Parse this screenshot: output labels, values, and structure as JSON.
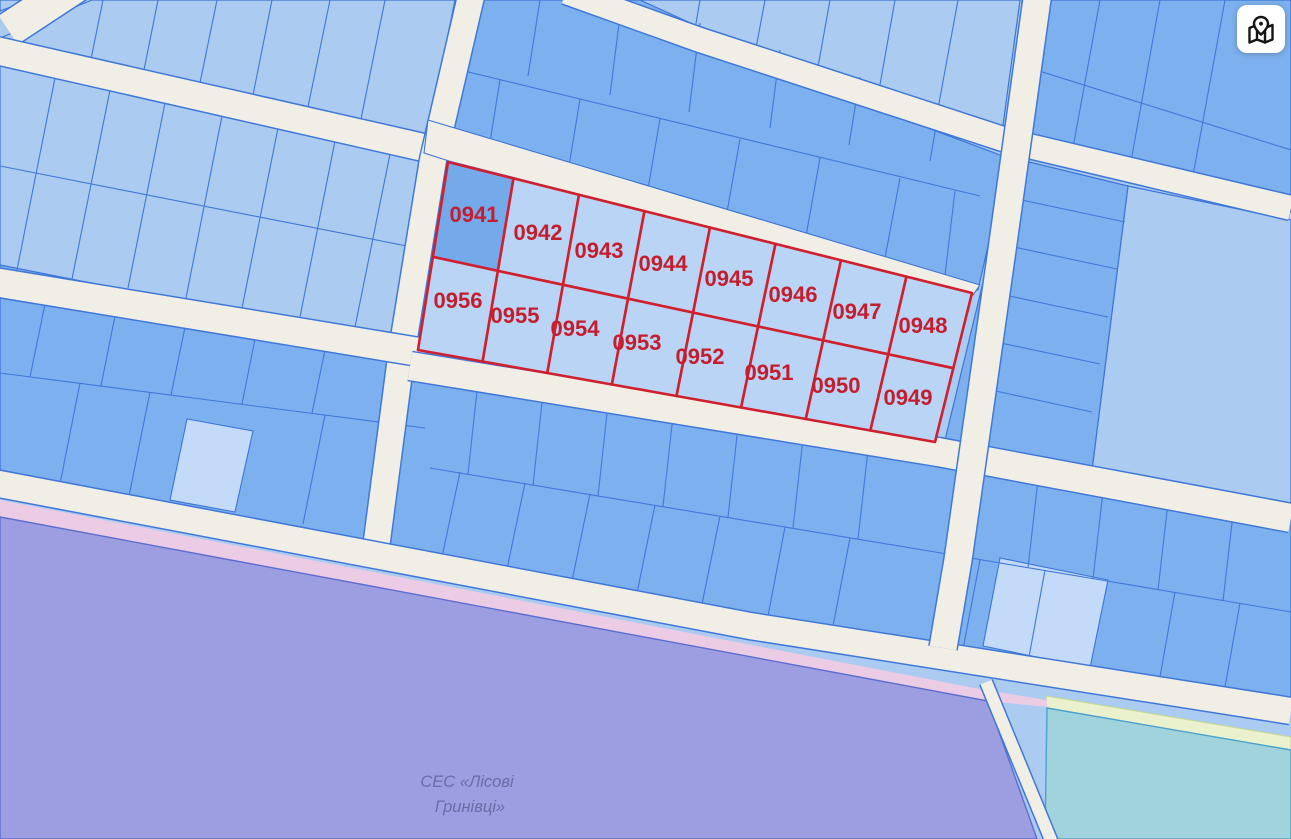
{
  "map_button": {
    "icon": "map-location-icon"
  },
  "highlighted_parcels": {
    "labels": [
      "0941",
      "0942",
      "0943",
      "0944",
      "0945",
      "0946",
      "0947",
      "0948",
      "0949",
      "0950",
      "0951",
      "0952",
      "0953",
      "0954",
      "0955",
      "0956"
    ],
    "outline_color": "#d01f2d",
    "label_color": "#c41e2e",
    "fill_color": "#b9d4f4",
    "fill_color_first": "#74a9ea"
  },
  "zone": {
    "label_line1": "СЕС «Лісові",
    "label_line2": "Гринівці»",
    "label_color": "#6b6ba8",
    "purple_color": "#9c9ee1",
    "pink_edge_color": "#eccbe4",
    "teal_color": "#a0d3db",
    "lime_edge_color": "#eaf2cd"
  },
  "base_map_colors": {
    "parcel_light": "#abcbf1",
    "parcel_medium": "#7cb0ee",
    "parcel_border": "#4078d8",
    "road": "#f0eee5"
  }
}
